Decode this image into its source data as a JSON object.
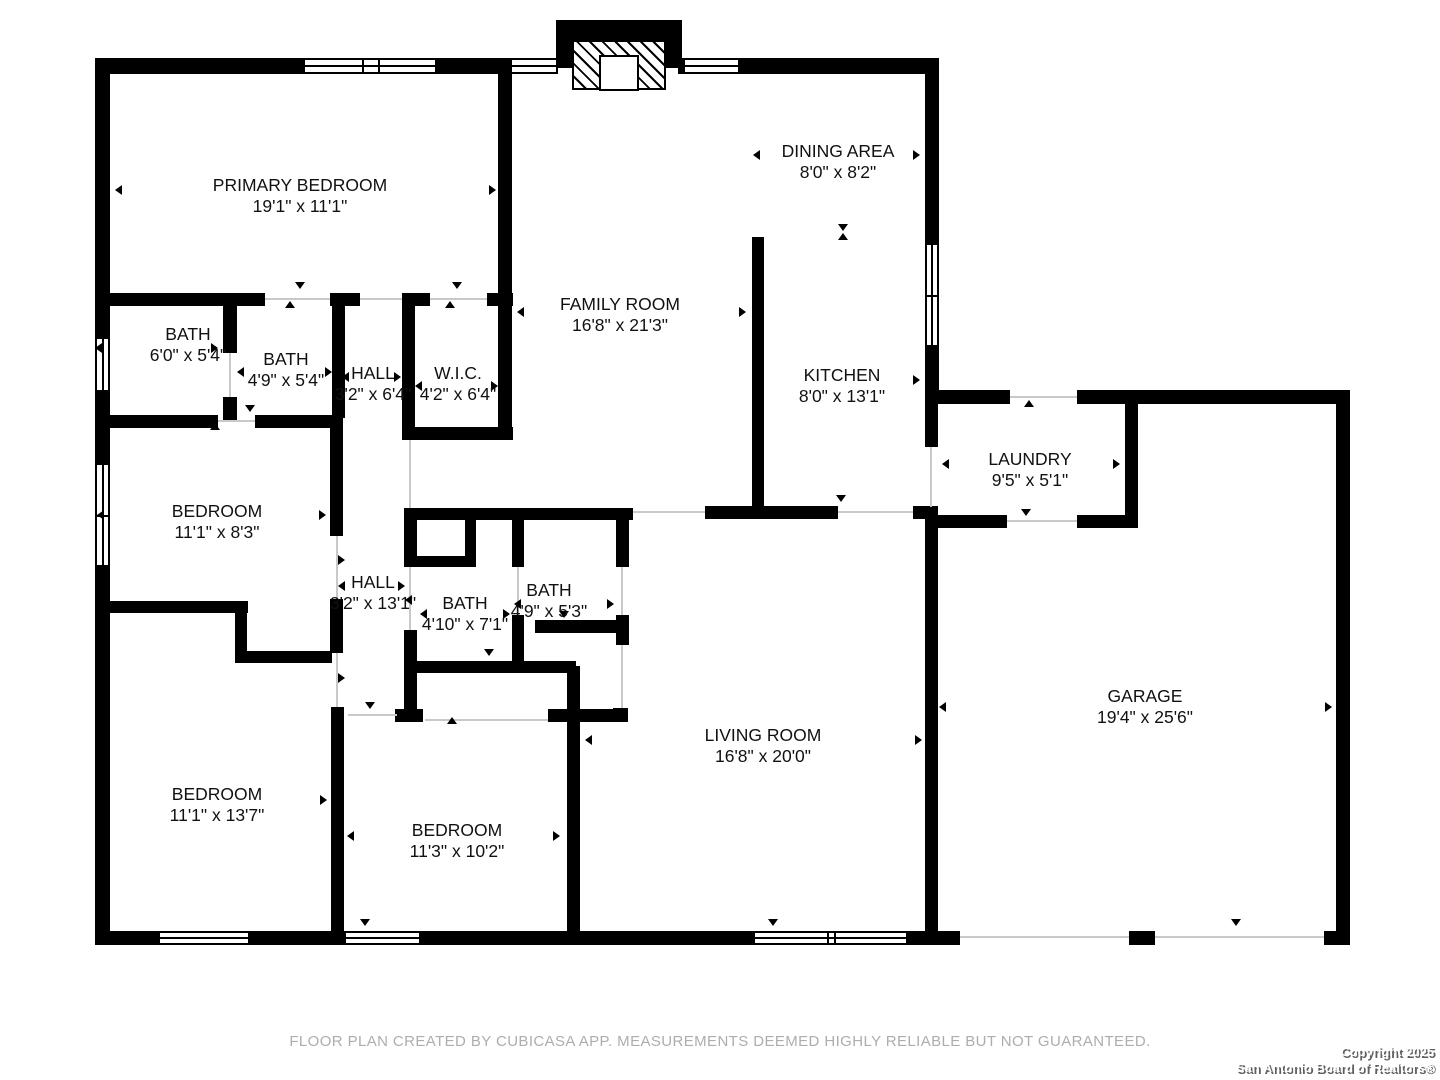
{
  "footer": {
    "disclaimer": "FLOOR PLAN CREATED BY CUBICASA APP. MEASUREMENTS DEEMED HIGHLY RELIABLE BUT NOT GUARANTEED.",
    "copyright_line1": "Copyright 2025",
    "copyright_line2": "San Antonio Board of Realtors®"
  },
  "colors": {
    "wall": "#000000",
    "label_text": "#111111",
    "disclaimer_text": "#adadad",
    "copyright_text": "#ffffff",
    "copyright_shadow": "#5f5f5f",
    "background": "#ffffff"
  },
  "plan": {
    "rooms": [
      {
        "name": "PRIMARY BEDROOM",
        "dims": "19'1\" x 11'1\"",
        "cx": 300,
        "cy": 196
      },
      {
        "name": "BATH",
        "dims": "6'0\" x 5'4\"",
        "cx": 188,
        "cy": 345
      },
      {
        "name": "BATH",
        "dims": "4'9\" x 5'4\"",
        "cx": 286,
        "cy": 370
      },
      {
        "name": "HALL",
        "dims": "3'2\" x 6'4\"",
        "cx": 373,
        "cy": 384
      },
      {
        "name": "W.I.C.",
        "dims": "4'2\" x 6'4\"",
        "cx": 458,
        "cy": 384
      },
      {
        "name": "FAMILY ROOM",
        "dims": "16'8\" x 21'3\"",
        "cx": 620,
        "cy": 315
      },
      {
        "name": "DINING AREA",
        "dims": "8'0\" x 8'2\"",
        "cx": 838,
        "cy": 162
      },
      {
        "name": "KITCHEN",
        "dims": "8'0\" x 13'1\"",
        "cx": 842,
        "cy": 386
      },
      {
        "name": "LAUNDRY",
        "dims": "9'5\" x 5'1\"",
        "cx": 1030,
        "cy": 470
      },
      {
        "name": "BEDROOM",
        "dims": "11'1\" x 8'3\"",
        "cx": 217,
        "cy": 522
      },
      {
        "name": "HALL",
        "dims": "3'2\" x 13'1\"",
        "cx": 373,
        "cy": 593
      },
      {
        "name": "BATH",
        "dims": "4'10\" x 7'1\"",
        "cx": 465,
        "cy": 614
      },
      {
        "name": "BATH",
        "dims": "4'9\" x 5'3\"",
        "cx": 549,
        "cy": 601
      },
      {
        "name": "GARAGE",
        "dims": "19'4\" x 25'6\"",
        "cx": 1145,
        "cy": 707
      },
      {
        "name": "LIVING ROOM",
        "dims": "16'8\" x 20'0\"",
        "cx": 763,
        "cy": 746
      },
      {
        "name": "BEDROOM",
        "dims": "11'3\" x 10'2\"",
        "cx": 457,
        "cy": 841
      },
      {
        "name": "BEDROOM",
        "dims": "11'1\" x 13'7\"",
        "cx": 217,
        "cy": 805
      }
    ],
    "walls": [
      [
        95,
        58,
        15,
        887
      ],
      [
        95,
        58,
        463,
        16
      ],
      [
        678,
        58,
        247,
        16
      ],
      [
        925,
        58,
        14,
        346
      ],
      [
        925,
        390,
        85,
        14
      ],
      [
        1077,
        390,
        273,
        14
      ],
      [
        1336,
        390,
        14,
        555
      ],
      [
        1324,
        931,
        26,
        14
      ],
      [
        1129,
        931,
        26,
        14
      ],
      [
        95,
        931,
        865,
        14
      ],
      [
        95,
        293,
        170,
        13
      ],
      [
        330,
        293,
        30,
        13
      ],
      [
        402,
        293,
        28,
        13
      ],
      [
        487,
        293,
        26,
        13
      ],
      [
        498,
        58,
        14,
        382
      ],
      [
        223,
        306,
        14,
        47
      ],
      [
        223,
        397,
        14,
        23
      ],
      [
        332,
        306,
        13,
        112
      ],
      [
        402,
        306,
        13,
        134
      ],
      [
        415,
        427,
        98,
        13
      ],
      [
        95,
        415,
        123,
        13
      ],
      [
        255,
        415,
        77,
        13
      ],
      [
        330,
        415,
        13,
        121
      ],
      [
        330,
        599,
        13,
        54
      ],
      [
        331,
        707,
        13,
        226
      ],
      [
        102,
        601,
        146,
        12
      ],
      [
        235,
        601,
        12,
        62
      ],
      [
        235,
        651,
        97,
        12
      ],
      [
        404,
        508,
        229,
        12
      ],
      [
        404,
        520,
        13,
        47
      ],
      [
        404,
        630,
        13,
        92
      ],
      [
        395,
        709,
        28,
        13
      ],
      [
        465,
        520,
        11,
        47
      ],
      [
        404,
        556,
        72,
        11
      ],
      [
        512,
        520,
        12,
        47
      ],
      [
        512,
        615,
        12,
        58
      ],
      [
        404,
        661,
        172,
        12
      ],
      [
        616,
        508,
        13,
        59
      ],
      [
        616,
        615,
        13,
        30
      ],
      [
        613,
        708,
        15,
        14
      ],
      [
        535,
        620,
        81,
        13
      ],
      [
        567,
        666,
        13,
        267
      ],
      [
        548,
        709,
        80,
        13
      ],
      [
        752,
        237,
        12,
        281
      ],
      [
        705,
        506,
        133,
        13
      ],
      [
        913,
        506,
        25,
        13
      ],
      [
        925,
        404,
        13,
        43
      ],
      [
        925,
        507,
        13,
        426
      ],
      [
        1125,
        404,
        13,
        111
      ],
      [
        925,
        515,
        82,
        13
      ],
      [
        1077,
        515,
        61,
        13
      ]
    ],
    "windows": [
      {
        "x": 303,
        "y": 58,
        "w": 134,
        "h": 16,
        "o": "h",
        "t": [
          0.44,
          0.56
        ]
      },
      {
        "x": 510,
        "y": 58,
        "w": 48,
        "h": 16,
        "o": "h",
        "t": []
      },
      {
        "x": 683,
        "y": 58,
        "w": 57,
        "h": 16,
        "o": "h",
        "t": []
      },
      {
        "x": 925,
        "y": 243,
        "w": 14,
        "h": 104,
        "o": "v",
        "t": [
          0.5
        ]
      },
      {
        "x": 95,
        "y": 337,
        "w": 15,
        "h": 55,
        "o": "v",
        "t": []
      },
      {
        "x": 95,
        "y": 463,
        "w": 15,
        "h": 104,
        "o": "v",
        "t": [
          0.5
        ]
      },
      {
        "x": 158,
        "y": 931,
        "w": 92,
        "h": 14,
        "o": "h",
        "t": []
      },
      {
        "x": 344,
        "y": 931,
        "w": 77,
        "h": 14,
        "o": "h",
        "t": []
      },
      {
        "x": 753,
        "y": 931,
        "w": 155,
        "h": 14,
        "o": "h",
        "t": [
          0.48,
          0.52
        ]
      }
    ],
    "opening_lines": [
      [
        265,
        298,
        65,
        2
      ],
      [
        360,
        298,
        42,
        2
      ],
      [
        430,
        298,
        57,
        2
      ],
      [
        218,
        420,
        37,
        2
      ],
      [
        336,
        536,
        2,
        63
      ],
      [
        336,
        653,
        2,
        54
      ],
      [
        409,
        440,
        2,
        68
      ],
      [
        409,
        567,
        2,
        63
      ],
      [
        229,
        353,
        2,
        44
      ],
      [
        517,
        567,
        2,
        48
      ],
      [
        621,
        567,
        2,
        48
      ],
      [
        621,
        645,
        2,
        63
      ],
      [
        425,
        719,
        123,
        2
      ],
      [
        348,
        714,
        49,
        2
      ],
      [
        633,
        511,
        72,
        2
      ],
      [
        838,
        511,
        75,
        2
      ],
      [
        1010,
        396,
        67,
        2
      ],
      [
        1007,
        520,
        70,
        2
      ],
      [
        930,
        447,
        2,
        60
      ],
      [
        960,
        936,
        169,
        2
      ],
      [
        1155,
        936,
        169,
        2
      ]
    ],
    "markers": [
      [
        300,
        287,
        "d"
      ],
      [
        290,
        306,
        "u"
      ],
      [
        457,
        287,
        "d"
      ],
      [
        450,
        306,
        "u"
      ],
      [
        843,
        66,
        "u"
      ],
      [
        843,
        229,
        "d"
      ],
      [
        843,
        238,
        "u"
      ],
      [
        841,
        500,
        "d"
      ],
      [
        770,
        517,
        "u"
      ],
      [
        1029,
        405,
        "u"
      ],
      [
        1026,
        514,
        "d"
      ],
      [
        1233,
        401,
        "u"
      ],
      [
        1236,
        924,
        "d"
      ],
      [
        370,
        707,
        "d"
      ],
      [
        452,
        722,
        "u"
      ],
      [
        489,
        654,
        "d"
      ],
      [
        564,
        616,
        "d"
      ],
      [
        215,
        428,
        "u"
      ],
      [
        250,
        410,
        "d"
      ],
      [
        365,
        924,
        "d"
      ],
      [
        773,
        924,
        "d"
      ],
      [
        120,
        190,
        "l"
      ],
      [
        494,
        190,
        "r"
      ],
      [
        758,
        155,
        "l"
      ],
      [
        918,
        155,
        "r"
      ],
      [
        522,
        312,
        "l"
      ],
      [
        744,
        312,
        "r"
      ],
      [
        760,
        380,
        "l"
      ],
      [
        918,
        380,
        "r"
      ],
      [
        947,
        464,
        "l"
      ],
      [
        1118,
        464,
        "r"
      ],
      [
        944,
        707,
        "l"
      ],
      [
        1330,
        707,
        "r"
      ],
      [
        590,
        740,
        "l"
      ],
      [
        920,
        740,
        "r"
      ],
      [
        352,
        836,
        "l"
      ],
      [
        558,
        836,
        "r"
      ],
      [
        102,
        800,
        "l"
      ],
      [
        325,
        800,
        "r"
      ],
      [
        102,
        515,
        "l"
      ],
      [
        324,
        515,
        "r"
      ],
      [
        100,
        348,
        "l"
      ],
      [
        216,
        348,
        "r"
      ],
      [
        242,
        372,
        "l"
      ],
      [
        330,
        372,
        "r"
      ],
      [
        347,
        377,
        "l"
      ],
      [
        399,
        377,
        "r"
      ],
      [
        420,
        386,
        "l"
      ],
      [
        496,
        386,
        "r"
      ],
      [
        343,
        586,
        "l"
      ],
      [
        403,
        586,
        "r"
      ],
      [
        425,
        614,
        "l"
      ],
      [
        508,
        614,
        "r"
      ],
      [
        519,
        604,
        "l"
      ],
      [
        612,
        604,
        "r"
      ],
      [
        343,
        560,
        "r"
      ],
      [
        343,
        678,
        "r"
      ],
      [
        410,
        600,
        "l"
      ]
    ],
    "fireplace": {
      "chimney": [
        556,
        20,
        126,
        48
      ],
      "hatch": [
        572,
        40,
        94,
        50
      ],
      "firebox": [
        599,
        55,
        40,
        36
      ]
    }
  }
}
